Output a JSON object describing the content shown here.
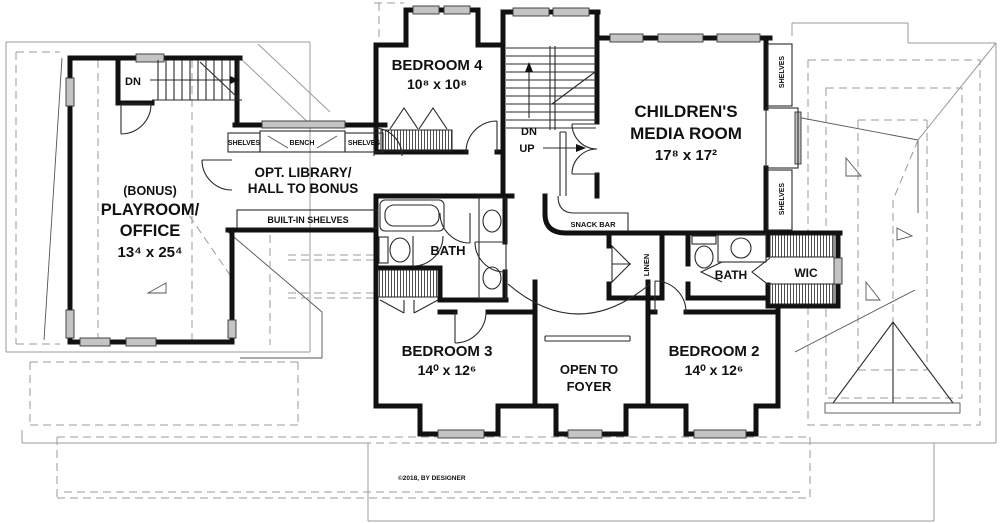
{
  "rooms": {
    "bedroom4": {
      "name": "BEDROOM 4",
      "dims": "10⁸ x 10⁸"
    },
    "media": {
      "name_line1": "CHILDREN'S",
      "name_line2": "MEDIA ROOM",
      "dims": "17⁸ x 17²"
    },
    "bonus": {
      "prefix": "(BONUS)",
      "name_line1": "PLAYROOM/",
      "name_line2": "OFFICE",
      "dims": "13⁴ x 25⁴"
    },
    "library": {
      "name_line1": "OPT. LIBRARY/",
      "name_line2": "HALL TO BONUS"
    },
    "bedroom3": {
      "name": "BEDROOM 3",
      "dims": "14⁰ x 12⁶"
    },
    "bedroom2": {
      "name": "BEDROOM 2",
      "dims": "14⁰ x 12⁶"
    },
    "foyer": {
      "name_line1": "OPEN TO",
      "name_line2": "FOYER"
    },
    "bath1": {
      "name": "BATH"
    },
    "bath2": {
      "name": "BATH"
    },
    "wic": {
      "name": "WIC"
    },
    "linen": {
      "name": "LINEN"
    }
  },
  "features": {
    "shelves_left": "SHELVES",
    "bench": "BENCH",
    "shelves_right": "SHELVES",
    "built_in_shelves": "BUILT-IN SHELVES",
    "snack_bar": "SNACK BAR",
    "shelves_v_top": "SHELVES",
    "shelves_v_bottom": "SHELVES"
  },
  "stairs": {
    "dn_left": "DN",
    "dn_center": "DN",
    "up_center": "UP"
  },
  "footer": {
    "copyright": "©2018, BY DESIGNER"
  },
  "colors": {
    "wall": "#111111",
    "roof_line": "#9b9b9b",
    "window_fill": "#c4c4c4"
  }
}
